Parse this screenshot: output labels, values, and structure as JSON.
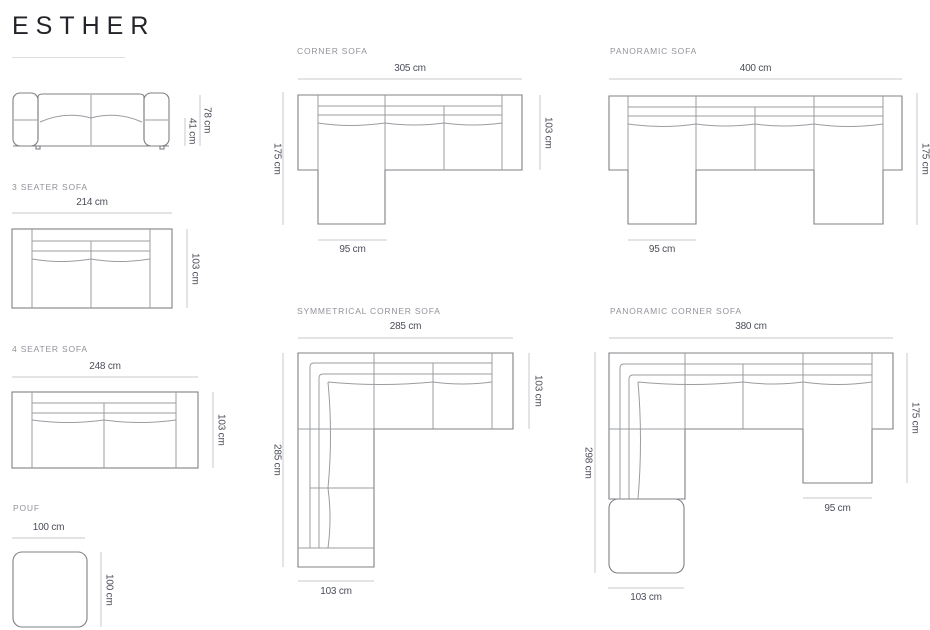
{
  "brand": {
    "title": "ESTHER"
  },
  "diagrams": {
    "side_view": {
      "overall_height": "78 cm",
      "seat_height": "41 cm"
    },
    "three_seater": {
      "label": "3 SEATER SOFA",
      "width": "214 cm",
      "depth": "103 cm"
    },
    "four_seater": {
      "label": "4 SEATER SOFA",
      "width": "248 cm",
      "depth": "103 cm"
    },
    "pouf": {
      "label": "POUF",
      "width": "100 cm",
      "depth": "100 cm"
    },
    "corner": {
      "label": "CORNER SOFA",
      "width": "305 cm",
      "depth": "103 cm",
      "chaise_length": "175 cm",
      "chaise_width": "95 cm"
    },
    "panoramic": {
      "label": "PANORAMIC SOFA",
      "width": "400 cm",
      "chaise_length": "175 cm",
      "chaise_width": "95 cm"
    },
    "symmetrical_corner": {
      "label": "SYMMETRICAL CORNER SOFA",
      "width": "285 cm",
      "depth": "103 cm",
      "side_length": "285 cm",
      "side_width": "103 cm"
    },
    "panoramic_corner": {
      "label": "PANORAMIC CORNER SOFA",
      "width": "380 cm",
      "side_length": "298 cm",
      "chaise_length": "175 cm",
      "chaise_width": "95 cm",
      "corner_width": "103 cm"
    }
  },
  "colors": {
    "outline_stroke": "#7f8086",
    "inner_stroke": "#9b9ca1",
    "dimension_line": "#c9cace",
    "dimension_text": "#4a4e58",
    "section_label_text": "#92929b",
    "title_text": "#232329"
  }
}
